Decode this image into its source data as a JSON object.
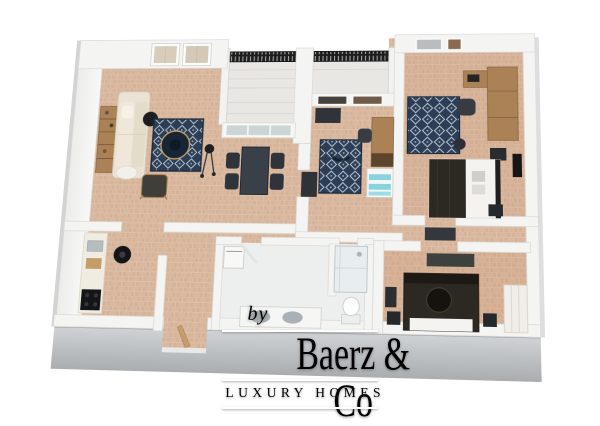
{
  "watermark": {
    "prefix": "by",
    "brand": "Baerz & Co",
    "tagline": "LUXURY HOMES"
  },
  "colors": {
    "background": "#ffffff",
    "floor_tile": "#d9b89f",
    "floor_tile_alt": "#cfa88c",
    "wall_top": "#f4f4f2",
    "wall_side": "#bfc3c6",
    "wall_side_dark": "#a6abae",
    "balcony_floor": "#e9e7e3",
    "bathroom_floor": "#edefee",
    "railing": "#1d1d1d",
    "railing_slit": "#e8e8e8",
    "rug_navy": "#2c3e55",
    "rug_motif": "#b9c6d2",
    "sofa_beige": "#e9e2d5",
    "pouf_white": "#f2f0eb",
    "wood": "#ab8156",
    "furniture_dark": "#2e343a",
    "table_dark": "#394047",
    "bed_dark": "#2c2822",
    "linen_white": "#f4f3f0",
    "teal_accent": "#85d4e0",
    "art_black": "#161616",
    "cooktop_black": "#141517",
    "watermark_white": "#ffffff"
  }
}
